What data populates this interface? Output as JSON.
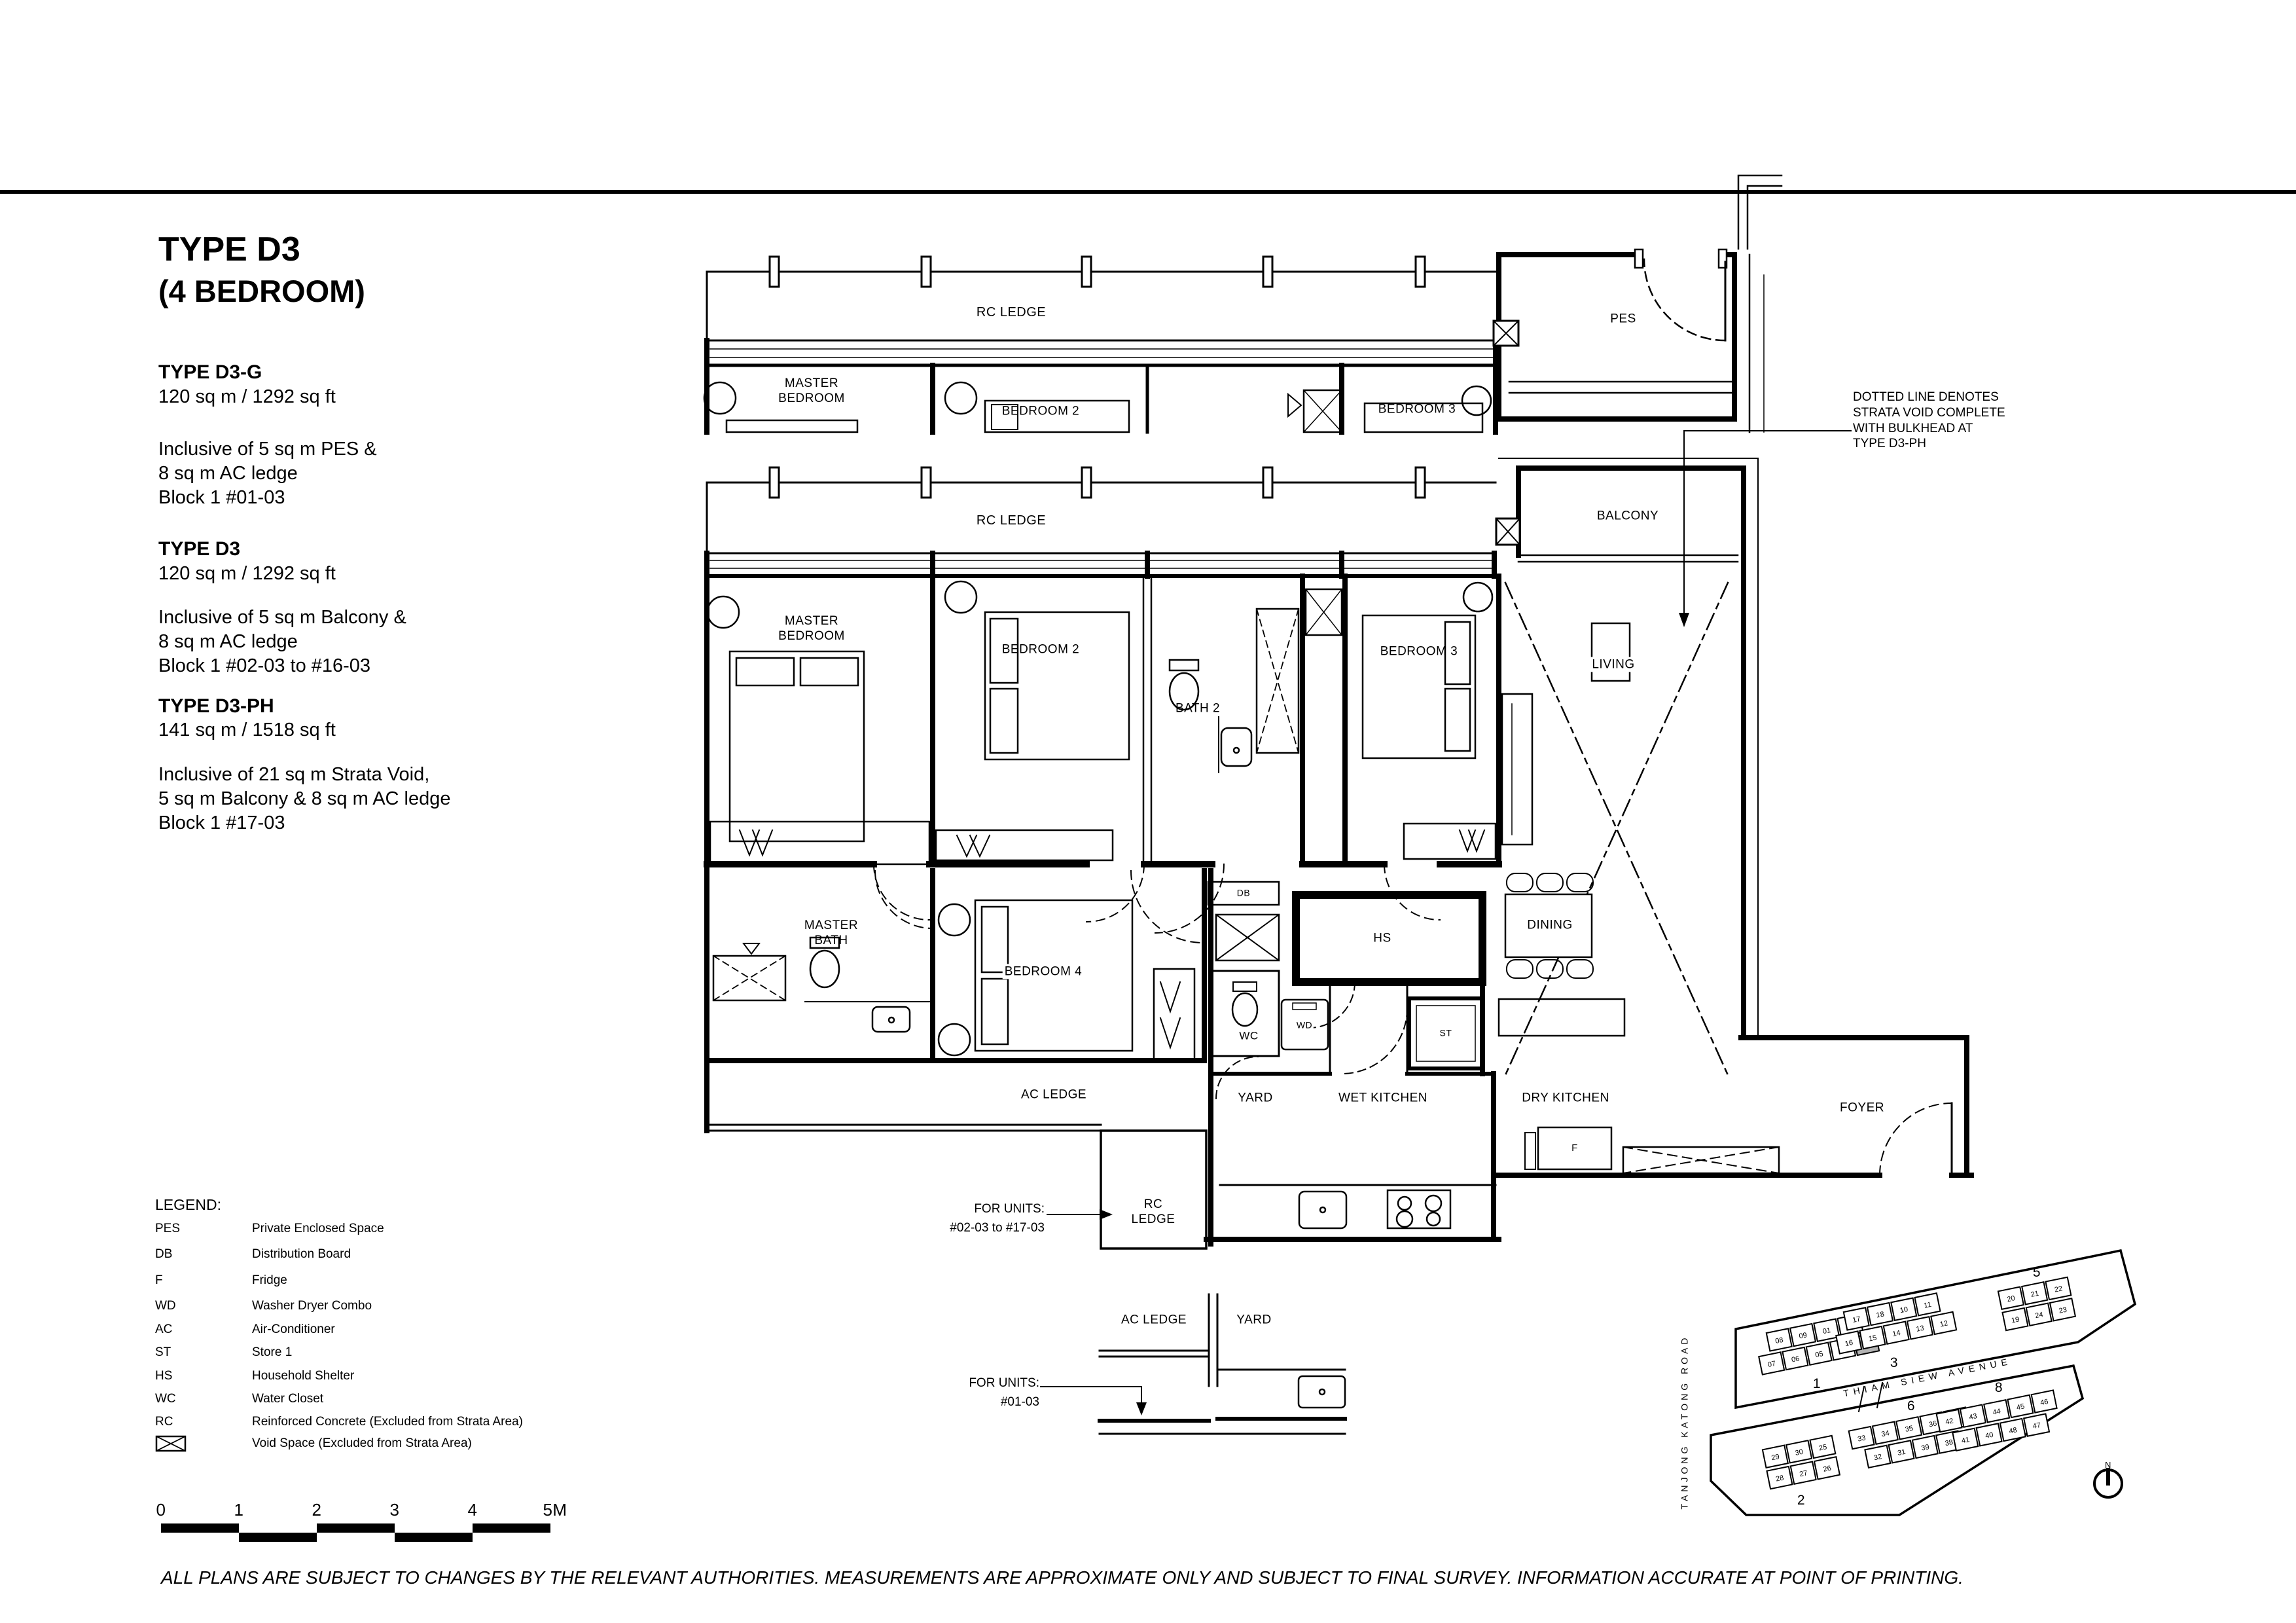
{
  "page": {
    "bg": "#ffffff",
    "ink": "#000000",
    "highlight": "#b3b3b3"
  },
  "header": {
    "title": "TYPE  D3",
    "subtitle": "(4 BEDROOM)"
  },
  "types": [
    {
      "name": "TYPE D3-G",
      "area": "120 sq m / 1292 sq ft",
      "details": "Inclusive of 5 sq m PES &\n8 sq m AC ledge\nBlock 1  #01-03"
    },
    {
      "name": "TYPE D3",
      "area": "120 sq m / 1292 sq ft",
      "details": "Inclusive of 5 sq m Balcony &\n8 sq m AC ledge\nBlock 1  #02-03 to #16-03"
    },
    {
      "name": "TYPE D3-PH",
      "area": "141 sq m / 1518 sq ft",
      "details": "Inclusive of 21 sq m Strata Void,\n5 sq m Balcony & 8 sq m AC ledge\nBlock 1  #17-03"
    }
  ],
  "note": "DOTTED LINE DENOTES\nSTRATA VOID COMPLETE\nWITH BULKHEAD AT\nTYPE D3-PH",
  "plan": {
    "rc_ledge": "RC LEDGE",
    "rc_ledge_stacked": "RC\nLEDGE",
    "master_bedroom": "MASTER\nBEDROOM",
    "bedroom2": "BEDROOM 2",
    "bedroom3": "BEDROOM 3",
    "bath2": "BATH 2",
    "master_bath": "MASTER\nBATH",
    "bedroom4": "BEDROOM 4",
    "pes": "PES",
    "balcony": "BALCONY",
    "living": "LIVING",
    "dining": "DINING",
    "foyer": "FOYER",
    "ac_ledge": "AC LEDGE",
    "yard": "YARD",
    "wet_kitchen": "WET KITCHEN",
    "dry_kitchen": "DRY KITCHEN",
    "db": "DB",
    "hs": "HS",
    "wc": "WC",
    "wd": "WD",
    "st": "ST",
    "f": "F"
  },
  "callouts": {
    "upper": "FOR UNITS:\n#02-03 to #17-03",
    "lower": "FOR UNITS:\n#01-03"
  },
  "legend": {
    "title": "LEGEND:",
    "items": [
      {
        "abbr": "PES",
        "desc": "Private Enclosed Space"
      },
      {
        "abbr": "DB",
        "desc": "Distribution Board"
      },
      {
        "abbr": "F",
        "desc": "Fridge"
      },
      {
        "abbr": "WD",
        "desc": "Washer Dryer Combo"
      },
      {
        "abbr": "AC",
        "desc": "Air-Conditioner"
      },
      {
        "abbr": "ST",
        "desc": "Store 1"
      },
      {
        "abbr": "HS",
        "desc": "Household Shelter"
      },
      {
        "abbr": "WC",
        "desc": "Water Closet"
      },
      {
        "abbr": "RC",
        "desc": "Reinforced Concrete (Excluded from Strata Area)"
      }
    ],
    "void_desc": "Void Space (Excluded from Strata Area)"
  },
  "scale": {
    "ticks": [
      "0",
      "1",
      "2",
      "3",
      "4",
      "5M"
    ]
  },
  "disclaimer": "ALL PLANS ARE SUBJECT TO CHANGES BY THE RELEVANT AUTHORITIES. MEASUREMENTS ARE APPROXIMATE ONLY AND SUBJECT TO FINAL SURVEY. INFORMATION ACCURATE AT POINT OF PRINTING.",
  "site_plan": {
    "roads": {
      "left": "TANJONG   KATONG   ROAD",
      "middle": "THIAM    SIEW    AVENUE"
    },
    "north": "N",
    "highlight_unit": "03",
    "clusters": [
      {
        "label": "1",
        "top": [
          "08",
          "09",
          "01",
          "02"
        ],
        "bottom": [
          "07",
          "06",
          "05",
          "04",
          "03"
        ]
      },
      {
        "label": "3",
        "top": [
          "17",
          "18",
          "10",
          "11"
        ],
        "bottom": [
          "16",
          "15",
          "14",
          "13",
          "12"
        ]
      },
      {
        "label": "5",
        "top": [
          "20",
          "21",
          "22"
        ],
        "bottom": [
          "19",
          "24",
          "23"
        ]
      },
      {
        "label": "2",
        "top": [
          "29",
          "30",
          "25"
        ],
        "bottom": [
          "28",
          "27",
          "26"
        ]
      },
      {
        "label": "6",
        "top": [
          "33",
          "34",
          "35",
          "36",
          "37"
        ],
        "bottom": [
          "32",
          "31",
          "39",
          "38"
        ]
      },
      {
        "label": "8",
        "top": [
          "42",
          "43",
          "44",
          "45",
          "46"
        ],
        "bottom": [
          "41",
          "40",
          "48",
          "47"
        ]
      }
    ]
  }
}
